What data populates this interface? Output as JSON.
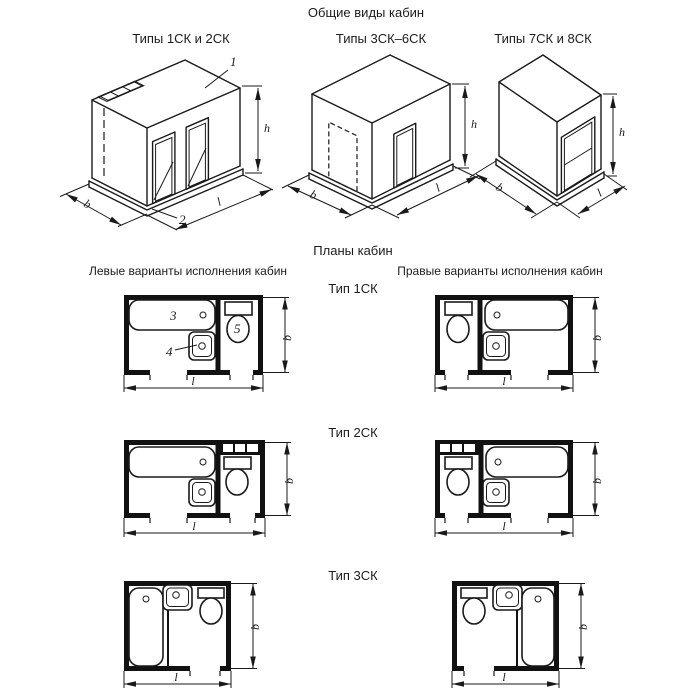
{
  "page": {
    "title": "Общие виды кабин",
    "plans_title": "Планы кабин",
    "left_variants": "Левые варианты исполнения кабин",
    "right_variants": "Правые варианты исполнения кабин"
  },
  "general_views": {
    "view1_label": "Типы 1СК и 2СК",
    "view2_label": "Типы 3СК–6СК",
    "view3_label": "Типы 7СК и 8СК"
  },
  "plans": {
    "type1_label": "Тип 1СК",
    "type2_label": "Тип 2СК",
    "type3_label": "Тип 3СК"
  },
  "dimension_labels": {
    "height": "h",
    "width": "b",
    "length": "l"
  },
  "callouts": {
    "cabin": "1",
    "base": "2",
    "bath": "3",
    "washbasin": "4",
    "toilet": "5"
  },
  "colors": {
    "ink": "#1a1a1a",
    "paper": "#ffffff"
  }
}
